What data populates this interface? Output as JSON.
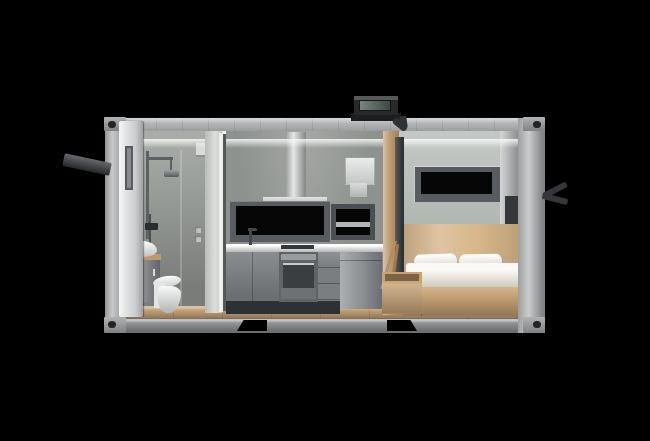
{
  "scene": {
    "name": "Container tiny-home cutaway 3D render",
    "type": "3d-product-render",
    "view": "front section view on black background",
    "rooms": [
      {
        "name": "bathroom",
        "position": "left",
        "items": [
          "open-entry-door",
          "door-window",
          "shower-set",
          "handheld-shower",
          "wall-mixer",
          "vessel-sink",
          "wood-vanity-top",
          "vanity-cabinet",
          "toilet",
          "wall-vent",
          "light-switches",
          "glass-screen"
        ]
      },
      {
        "name": "kitchen",
        "position": "center",
        "items": [
          "range-hood-chimney",
          "range-hood",
          "backsplash-window-large",
          "backsplash-window-small",
          "water-heater",
          "sink-faucet",
          "countertop",
          "cooktop",
          "built-in-oven",
          "base-cabinets",
          "drawer-unit",
          "refrigerator"
        ]
      },
      {
        "name": "bedroom",
        "position": "right",
        "items": [
          "wide-window",
          "wood-headboard",
          "double-bed-mattress",
          "two-pillows",
          "storage-bed-base",
          "wall-niche",
          "wood-storage-box",
          "ladder-poles"
        ]
      }
    ],
    "exterior_features": [
      "steel-frame",
      "corner-castings",
      "forklift-pockets",
      "roof-vent-unit",
      "exhaust-duct",
      "wood-partition-column",
      "open-door-handle",
      "side-wall-hook",
      "wood-plank-floor"
    ]
  },
  "colors": {
    "background": "#000000",
    "shell_back": "#70746f",
    "frame": "#b2b4b6",
    "rail_top": "#b4b6b8",
    "rail_bottom": "#95979a",
    "casting": "#96989a",
    "pocket": "#000000",
    "door": "#e4e6e6",
    "handle": "#34373a",
    "ceiling": "#f1f3f2",
    "bath_wall": "#9b9f9b",
    "kitchen_wall": "#8e928e",
    "bed_wall": "#b5bbb7",
    "right_wall": "#c3c5c7",
    "partition": "#cfd1cf",
    "partition_edge": "#eef0ee",
    "partition_gap": "#545855",
    "wood_floor": "#c2a176",
    "wood_column": "#c29e72",
    "wood_bed": "#c6a275",
    "wood_headboard": "#d6b68a",
    "wood_vanity": "#bd9a6d",
    "stick_light": "#b58f60",
    "stick_dark": "#a07c4e",
    "cabinet": "#7b7e81",
    "oven": "#606467",
    "counter": "#e9ebea",
    "fridge": "#8d9194",
    "hood": "#c6c8c9",
    "heater": "#d5d7d7",
    "heater_stub": "#c9cbcb",
    "window_frame": "#585c60",
    "window_frame_small": "#4b4f53",
    "window_band": "#b2b4b6",
    "glass": "#060606",
    "white": "#eef0f0",
    "tank_white": "#e3e5e5",
    "mattress": "#eae8dc",
    "pillow": "#f5f3ed",
    "metal": "#5d6163",
    "hand_metal": "#4c5052",
    "shower_head": "#74787a",
    "mixer": "#2a2d2f",
    "faucet": "#44484b",
    "duct": "#3d4144",
    "duct_dark": "#303336",
    "vent_body": "#27292b",
    "vent_base": "#1b1d1f",
    "vent_glass": "#5a675f",
    "kick": "#2e3134",
    "hob": "#34373b",
    "niche": "#35383a",
    "vent_box": "#d9dbd9",
    "switch": "#c0c2c0",
    "bath_jamb": "#d5d7d5"
  }
}
